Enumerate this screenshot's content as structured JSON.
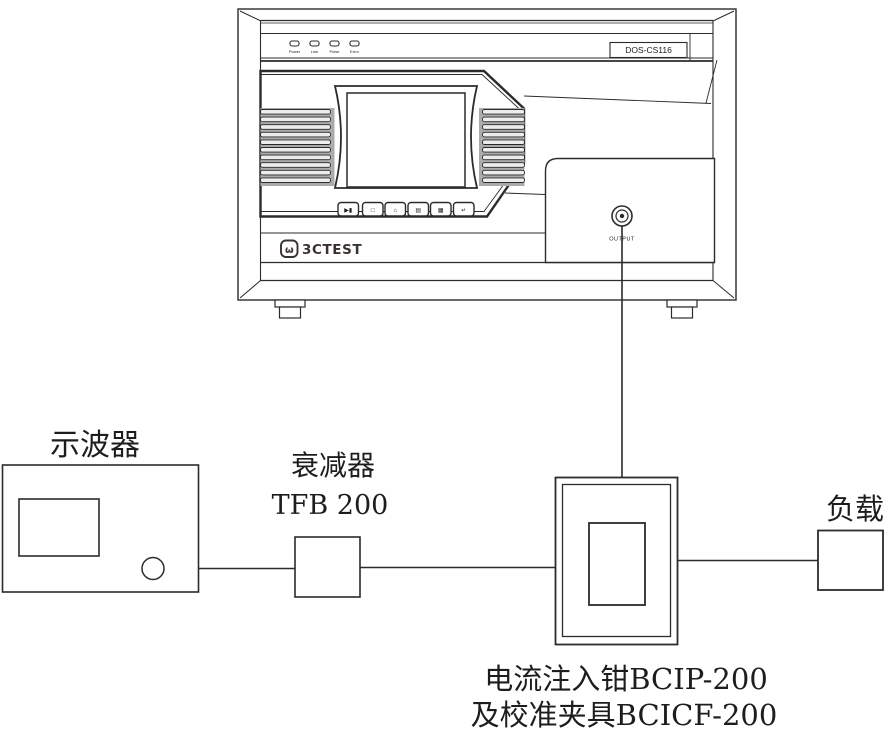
{
  "device": {
    "model": "DOS-CS116",
    "brand": "3CTEST",
    "brand_icon": "ω",
    "output_label": "OUTPUT",
    "leds": [
      "Power",
      "Line",
      "Pulse",
      "Error"
    ],
    "buttons": [
      "▶▮",
      "□",
      "⌂",
      "▤",
      "▦",
      "↵"
    ]
  },
  "nodes": {
    "oscilloscope": "示波器",
    "attenuator_name": "衰减器",
    "attenuator_model": "TFB 200",
    "clamp_line1": "电流注入钳BCIP-200",
    "clamp_line2": "及校准夹具BCICF-200",
    "load": "负载"
  },
  "colors": {
    "ink": "#2b2b2b",
    "fin_background": "#ababab",
    "fin_slat": "#ededed",
    "logo": "#3a3230"
  }
}
